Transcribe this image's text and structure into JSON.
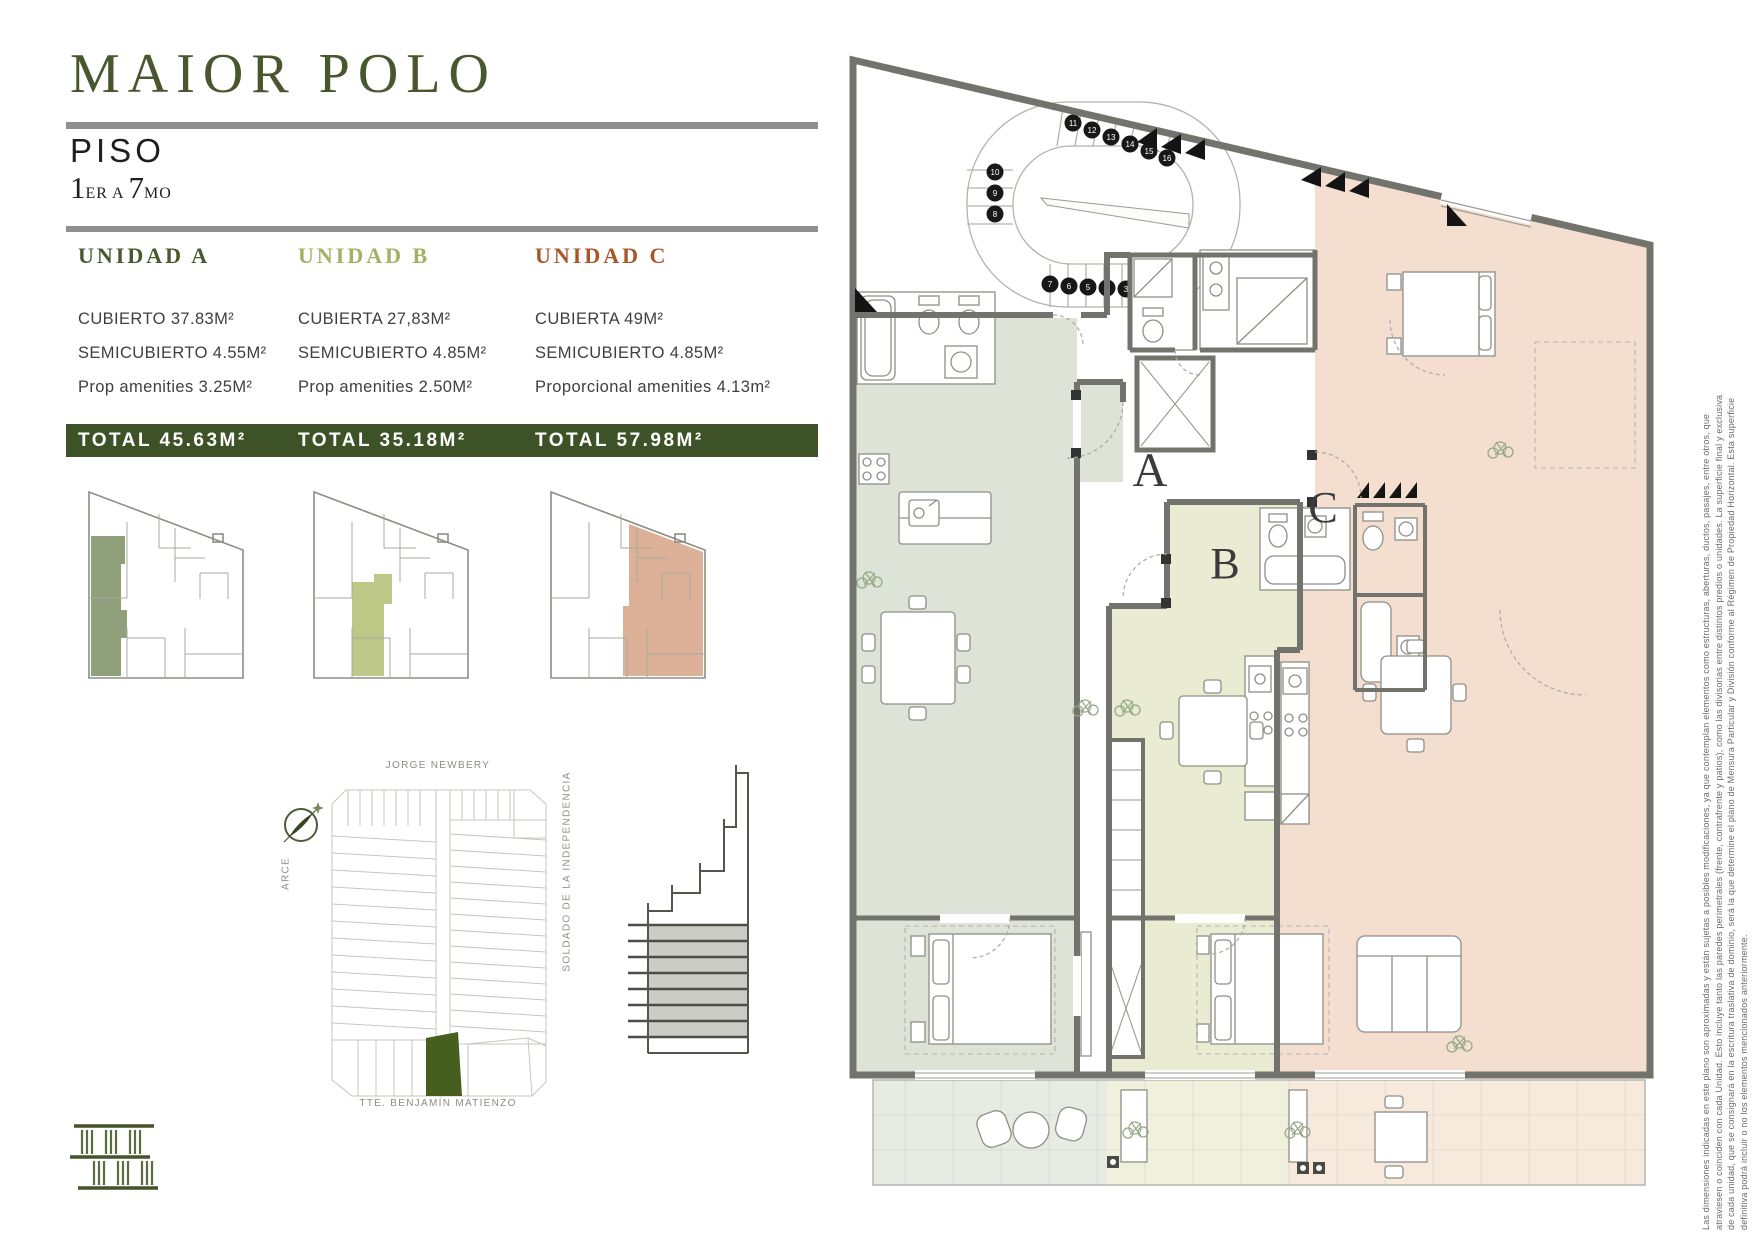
{
  "header": {
    "title": "MAIOR POLO",
    "floor_label": "PISO",
    "floor_num_1": "1",
    "floor_suffix_1": "ER",
    "floor_connector": "A",
    "floor_num_2": "7",
    "floor_suffix_2": "MO"
  },
  "units": [
    {
      "id": "A",
      "name": "UNIDAD A",
      "color": "#49582e",
      "rows": [
        "CUBIERTO 37.83M²",
        "SEMICUBIERTO 4.55M²",
        "Prop amenities 3.25M²"
      ],
      "total": "TOTAL 45.63M²",
      "highlight": "#8fa07b"
    },
    {
      "id": "B",
      "name": "UNIDAD B",
      "color": "#a3b162",
      "rows": [
        "CUBIERTA 27,83M²",
        "SEMICUBIERTO 4.85M²",
        "Prop amenities 2.50M²"
      ],
      "total": "TOTAL 35.18M²",
      "highlight": "#bdc887"
    },
    {
      "id": "C",
      "name": "UNIDAD C",
      "color": "#aa5528",
      "rows": [
        "CUBIERTA 49M²",
        "SEMICUBIERTO 4.85M²",
        "Proporcional amenities 4.13m²"
      ],
      "total": "TOTAL 57.98M²",
      "highlight": "#ddb197"
    }
  ],
  "map": {
    "street_top": "JORGE NEWBERY",
    "street_left": "ARCE",
    "street_right": "SOLDADO DE LA INDEPENDENCIA",
    "street_bottom": "TTE. BENJAMÍN MATIENZO"
  },
  "plan": {
    "unit_labels": {
      "a": "A",
      "b": "B",
      "c": "C"
    },
    "stair_numbers": {
      "top": [
        "11",
        "12",
        "13",
        "14",
        "15",
        "16"
      ],
      "left": [
        "10",
        "9",
        "8"
      ],
      "bottom": [
        "7",
        "6",
        "5",
        "4",
        "3",
        "2",
        "1"
      ]
    }
  },
  "legal": {
    "lines": [
      "Las dimensiones indicadas en este plano son aproximadas y están sujetas a posibles modificaciones, ya que contemplan elementos como estructuras, aberturas, ductos, pasajes, entre otros, que",
      "atraviesen o coinciden con cada Unidad. Esto incluye tanto las paredes perimetrales (frente, contrafrente y patios), como las divisorias entre distintos predios o unidades. La superficie final y exclusiva",
      "de cada unidad, que se consignará en la escritura traslativa de dominio, será la que determine el plano de Mensura Particular y División conforme al Régimen de Propiedad Horizontal. Esta superficie",
      "definitiva podrá incluir o no los elementos mencionados anteriormente."
    ]
  },
  "colors": {
    "title_green": "#49572f",
    "total_bar": "#3d5226",
    "unit_a_floor": "#dde3d7",
    "unit_b_floor": "#e9ebd2",
    "unit_c_floor": "#f4decf",
    "map_lot": "#465f1e"
  }
}
